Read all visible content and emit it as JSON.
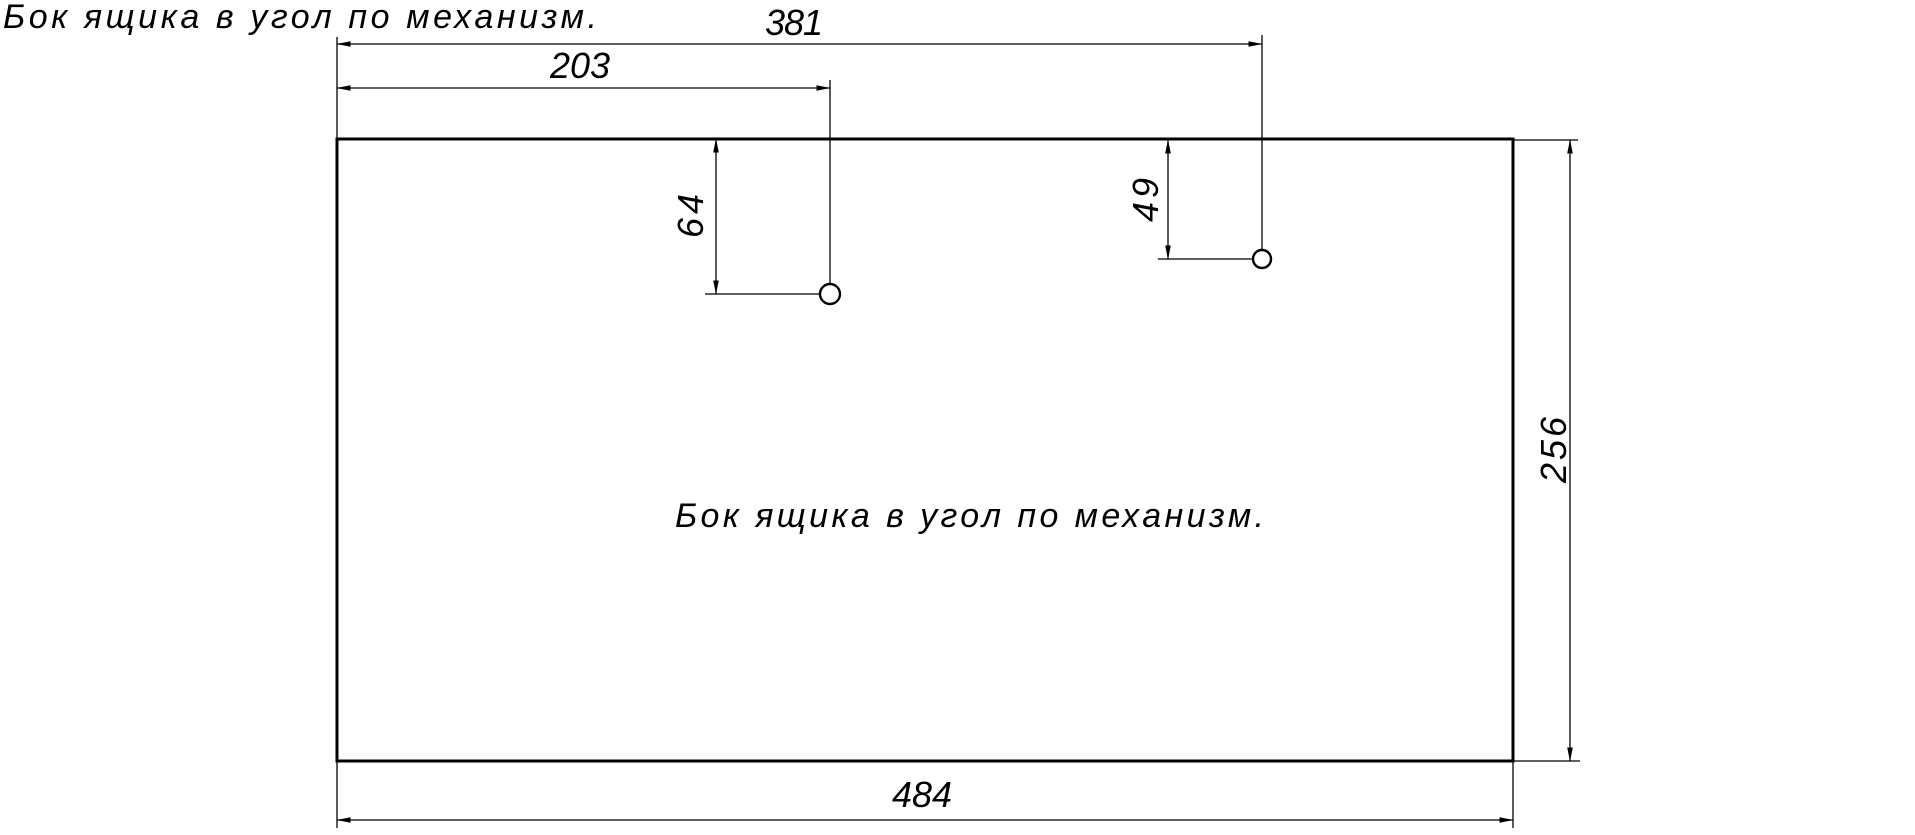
{
  "drawing": {
    "page_title": "Бок ящика в угол по механизм.",
    "part_label": "Бок ящика в угол по механизм.",
    "dimensions": {
      "overall_width": "484",
      "overall_height": "256",
      "hole1_offset_x": "203",
      "hole1_offset_y": "64",
      "hole2_offset_x": "381",
      "hole2_offset_y": "49"
    },
    "colors": {
      "line": "#000000",
      "background": "#ffffff"
    }
  }
}
